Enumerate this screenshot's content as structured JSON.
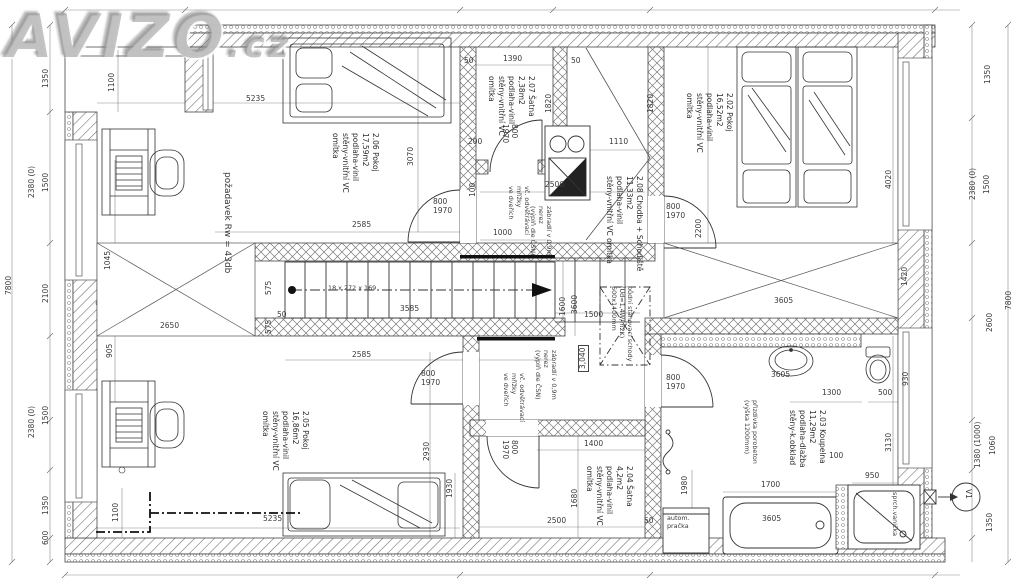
{
  "watermark": {
    "brand": "AVIZO",
    "tld": ".cz"
  },
  "plan": {
    "level_marker": "3,040",
    "vent_marker": "V1",
    "rooms": [
      {
        "x": 380,
        "y": 133,
        "r": 90,
        "lines": [
          "2.06 Pokoj",
          "17,59m2",
          "podlaha-vinil",
          "stěny-vnitřní VC",
          "omítka"
        ]
      },
      {
        "x": 536,
        "y": 76,
        "r": 90,
        "lines": [
          "2.07 Šatna",
          "2,38m2",
          "podlaha-vinil",
          "stěny-vnitřní VC",
          "omítka"
        ]
      },
      {
        "x": 644,
        "y": 176,
        "r": 90,
        "lines": [
          "2.08 Chodba + Schodiště",
          "11,33m2",
          "podlaha-vinil",
          "stěny-vnitřní VC omítka"
        ]
      },
      {
        "x": 734,
        "y": 93,
        "r": 90,
        "lines": [
          "2.02 Pokoj",
          "16,52m2",
          "podlaha-vinil",
          "stěny-vnitřní VC",
          "omítka"
        ]
      },
      {
        "x": 827,
        "y": 410,
        "r": 90,
        "lines": [
          "2.03 Koupelna",
          "11,29m2",
          "podlaha-dlažba",
          "stěny-k.obklad"
        ]
      },
      {
        "x": 634,
        "y": 466,
        "r": 90,
        "lines": [
          "2.04 Šatna",
          "4,2m2",
          "podlaha-vinil",
          "stěny-vnitřní VC",
          "omítka"
        ]
      },
      {
        "x": 310,
        "y": 411,
        "r": 90,
        "lines": [
          "2.05 Pokoj",
          "16,86m2",
          "podlaha-vinil",
          "stěny-vnitřní VC",
          "omítka"
        ]
      }
    ],
    "notes": [
      {
        "x": 232,
        "y": 172,
        "r": 90,
        "s": 9,
        "lines": [
          "požadavek Rw = 43db"
        ]
      },
      {
        "x": 634,
        "y": 286,
        "r": 90,
        "lines": [
          "půdní stahovací schody",
          "(Ud=1,4W/m2K)",
          "600x1400mm"
        ]
      },
      {
        "x": 553,
        "y": 206,
        "r": 90,
        "lines": [
          "zábradlí v 0,9m",
          "nerez",
          "(výplň dle ČSN)"
        ]
      },
      {
        "x": 558,
        "y": 350,
        "r": 90,
        "lines": [
          "zábradlí v 0,9m",
          "nerez",
          "(výplň dle ČSN)"
        ]
      },
      {
        "x": 531,
        "y": 186,
        "r": 90,
        "lines": [
          "vč. odvětrávací",
          "mřížky",
          "ve dveřích"
        ]
      },
      {
        "x": 526,
        "y": 373,
        "r": 90,
        "lines": [
          "vč. odvětrávací",
          "mřížky",
          "ve dveřích"
        ]
      },
      {
        "x": 759,
        "y": 400,
        "r": 90,
        "lines": [
          "přizdívka porobeton",
          "(výška 1200mm)"
        ]
      },
      {
        "x": 667,
        "y": 514,
        "lines": [
          "autom.",
          "pračka"
        ]
      },
      {
        "x": 899,
        "y": 492,
        "r": 90,
        "lines": [
          "sprch.vanička"
        ]
      },
      {
        "x": 328,
        "y": 284,
        "lines": [
          "18 x 272 x 169"
        ]
      }
    ],
    "door_labels": [
      {
        "t": "800\n1970",
        "x": 433,
        "y": 198
      },
      {
        "t": "800\n1970",
        "x": 518,
        "y": 124,
        "r": 90
      },
      {
        "t": "800\n1970",
        "x": 666,
        "y": 203
      },
      {
        "t": "800\n1970",
        "x": 666,
        "y": 374
      },
      {
        "t": "800\n1970",
        "x": 421,
        "y": 370
      },
      {
        "t": "800\n1970",
        "x": 518,
        "y": 440,
        "r": 90
      }
    ],
    "dimension_labels": [
      {
        "t": "7800",
        "x": 5,
        "y": 295,
        "r": 270
      },
      {
        "t": "1350",
        "x": 42,
        "y": 88,
        "r": 270
      },
      {
        "t": "2380 (0)",
        "x": 28,
        "y": 198,
        "r": 270
      },
      {
        "t": "1500",
        "x": 42,
        "y": 192,
        "r": 270
      },
      {
        "t": "2100",
        "x": 42,
        "y": 303,
        "r": 270
      },
      {
        "t": "1500",
        "x": 42,
        "y": 425,
        "r": 270
      },
      {
        "t": "2380 (0)",
        "x": 28,
        "y": 438,
        "r": 270
      },
      {
        "t": "1350",
        "x": 42,
        "y": 515,
        "r": 270
      },
      {
        "t": "600",
        "x": 42,
        "y": 545,
        "r": 270
      },
      {
        "t": "1100",
        "x": 108,
        "y": 92,
        "r": 270
      },
      {
        "t": "1045",
        "x": 104,
        "y": 270,
        "r": 270
      },
      {
        "t": "905",
        "x": 106,
        "y": 358,
        "r": 270
      },
      {
        "t": "1100",
        "x": 112,
        "y": 522,
        "r": 270
      },
      {
        "t": "2650",
        "x": 160,
        "y": 322
      },
      {
        "t": "575",
        "x": 265,
        "y": 295,
        "r": 270
      },
      {
        "t": "575",
        "x": 265,
        "y": 334,
        "r": 270
      },
      {
        "t": "50",
        "x": 277,
        "y": 311
      },
      {
        "t": "5235",
        "x": 246,
        "y": 95
      },
      {
        "t": "3070",
        "x": 407,
        "y": 166,
        "r": 270
      },
      {
        "t": "1390",
        "x": 503,
        "y": 55
      },
      {
        "t": "50",
        "x": 464,
        "y": 57
      },
      {
        "t": "50",
        "x": 571,
        "y": 57
      },
      {
        "t": "200",
        "x": 468,
        "y": 138
      },
      {
        "t": "1820",
        "x": 545,
        "y": 113,
        "r": 270
      },
      {
        "t": "1820",
        "x": 647,
        "y": 113,
        "r": 270
      },
      {
        "t": "1110",
        "x": 609,
        "y": 138
      },
      {
        "t": "2500",
        "x": 545,
        "y": 181
      },
      {
        "t": "1000",
        "x": 493,
        "y": 229
      },
      {
        "t": "100",
        "x": 469,
        "y": 197,
        "r": 270
      },
      {
        "t": "2200",
        "x": 695,
        "y": 238,
        "r": 270
      },
      {
        "t": "2585",
        "x": 352,
        "y": 221
      },
      {
        "t": "3585",
        "x": 400,
        "y": 305
      },
      {
        "t": "2585",
        "x": 352,
        "y": 351
      },
      {
        "t": "1600",
        "x": 559,
        "y": 316,
        "r": 270
      },
      {
        "t": "3600",
        "x": 571,
        "y": 314,
        "r": 270
      },
      {
        "t": "1500",
        "x": 584,
        "y": 311
      },
      {
        "t": "1400",
        "x": 584,
        "y": 440
      },
      {
        "t": "1680",
        "x": 571,
        "y": 508,
        "r": 270
      },
      {
        "t": "2500",
        "x": 547,
        "y": 517
      },
      {
        "t": "50",
        "x": 644,
        "y": 517
      },
      {
        "t": "2930",
        "x": 423,
        "y": 461,
        "r": 270
      },
      {
        "t": "1930",
        "x": 446,
        "y": 498,
        "r": 270
      },
      {
        "t": "5235",
        "x": 263,
        "y": 515
      },
      {
        "t": "1980",
        "x": 681,
        "y": 495,
        "r": 270
      },
      {
        "t": "4020",
        "x": 885,
        "y": 189,
        "r": 270
      },
      {
        "t": "1420",
        "x": 901,
        "y": 286,
        "r": 270
      },
      {
        "t": "3605",
        "x": 774,
        "y": 297
      },
      {
        "t": "3605",
        "x": 771,
        "y": 371
      },
      {
        "t": "1300",
        "x": 822,
        "y": 389
      },
      {
        "t": "500",
        "x": 878,
        "y": 389
      },
      {
        "t": "930",
        "x": 902,
        "y": 386,
        "r": 270
      },
      {
        "t": "3130",
        "x": 885,
        "y": 452,
        "r": 270
      },
      {
        "t": "100",
        "x": 829,
        "y": 452
      },
      {
        "t": "1700",
        "x": 761,
        "y": 481
      },
      {
        "t": "950",
        "x": 865,
        "y": 472
      },
      {
        "t": "3605",
        "x": 762,
        "y": 515
      },
      {
        "t": "2600",
        "x": 986,
        "y": 332,
        "r": 270
      },
      {
        "t": "1380 (1000)",
        "x": 974,
        "y": 468,
        "r": 270
      },
      {
        "t": "1060",
        "x": 989,
        "y": 455,
        "r": 270
      },
      {
        "t": "1350",
        "x": 986,
        "y": 532,
        "r": 270
      },
      {
        "t": "1350",
        "x": 984,
        "y": 84,
        "r": 270
      },
      {
        "t": "1500",
        "x": 983,
        "y": 194,
        "r": 270
      },
      {
        "t": "2380 (0)",
        "x": 969,
        "y": 200,
        "r": 270
      },
      {
        "t": "7800",
        "x": 1005,
        "y": 310,
        "r": 270
      }
    ]
  }
}
